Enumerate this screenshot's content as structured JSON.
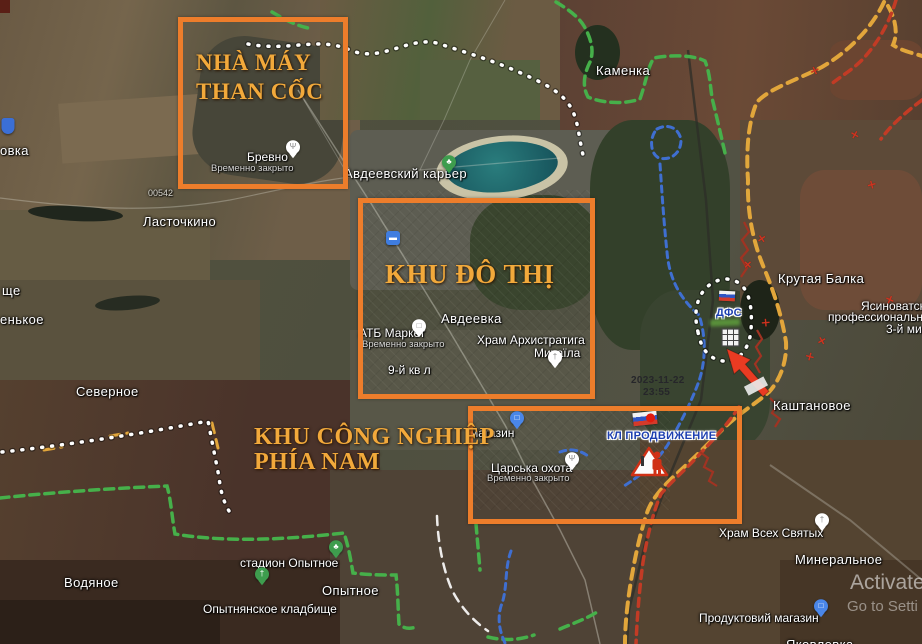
{
  "canvas": {
    "width": 922,
    "height": 644
  },
  "colors": {
    "annotation_orange": "#ed7d2b",
    "viet_yellow": "#f2a93b",
    "front_white": "#ffffff",
    "front_green": "#46b04a",
    "front_yellow": "#e2a63b",
    "front_red": "#c23b25",
    "front_blue": "#3f6fd1",
    "unit_blue": "#1d3fb0",
    "pin_white": "#ffffff",
    "pin_blue": "#4a86e8",
    "pin_green": "#3e9d4e"
  },
  "annotation_boxes": [
    {
      "name": "coke-plant-box",
      "x": 178,
      "y": 17,
      "w": 160,
      "h": 162
    },
    {
      "name": "urban-area-box",
      "x": 358,
      "y": 198,
      "w": 227,
      "h": 191
    },
    {
      "name": "south-industrial-box",
      "x": 468,
      "y": 406,
      "w": 264,
      "h": 108
    }
  ],
  "annotation_labels": [
    {
      "text": "NHÀ MÁY",
      "x": 196,
      "y": 50,
      "size": 23
    },
    {
      "text": "THAN CỐC",
      "x": 196,
      "y": 79,
      "size": 23
    },
    {
      "text": "KHU ĐÔ THỊ",
      "x": 385,
      "y": 259,
      "size": 27
    },
    {
      "text": "KHU CÔNG NGHIỆP",
      "x": 254,
      "y": 424,
      "size": 24
    },
    {
      "text": "PHÍA NAM",
      "x": 254,
      "y": 449,
      "size": 24
    }
  ],
  "map_labels": [
    {
      "text": "овка",
      "x": 0,
      "y": 143,
      "cls": "town"
    },
    {
      "text": "00542",
      "x": 148,
      "y": 188,
      "cls": "road"
    },
    {
      "text": "Ласточкино",
      "x": 143,
      "y": 214,
      "cls": "town"
    },
    {
      "text": "ще",
      "x": 2,
      "y": 283,
      "cls": "town"
    },
    {
      "text": "енькое",
      "x": 0,
      "y": 312,
      "cls": "town"
    },
    {
      "text": "Северное",
      "x": 76,
      "y": 384,
      "cls": "town"
    },
    {
      "text": "Водяное",
      "x": 64,
      "y": 575,
      "cls": "town"
    },
    {
      "text": "стадион Опытное",
      "x": 240,
      "y": 556,
      "cls": "poi"
    },
    {
      "text": "Опытное",
      "x": 322,
      "y": 583,
      "cls": "town"
    },
    {
      "text": "Опытнянское кладбище",
      "x": 203,
      "y": 602,
      "cls": "poi"
    },
    {
      "text": "Каменка",
      "x": 596,
      "y": 63,
      "cls": "town"
    },
    {
      "text": "Авдеевский карьер",
      "x": 344,
      "y": 166,
      "cls": "town"
    },
    {
      "text": "Бревно",
      "x": 247,
      "y": 150,
      "cls": "poi"
    },
    {
      "text": "Временно закрыто",
      "x": 211,
      "y": 163,
      "cls": "sub"
    },
    {
      "text": "Авдеевка",
      "x": 441,
      "y": 311,
      "cls": "town"
    },
    {
      "text": "АТБ Маркет",
      "x": 359,
      "y": 326,
      "cls": "poi"
    },
    {
      "text": "Временно закрыто",
      "x": 362,
      "y": 339,
      "cls": "sub"
    },
    {
      "text": "Храм Архистратига",
      "x": 477,
      "y": 333,
      "cls": "poi"
    },
    {
      "text": "Михаїла",
      "x": 534,
      "y": 346,
      "cls": "poi"
    },
    {
      "text": "9-й кв л",
      "x": 388,
      "y": 363,
      "cls": "poi"
    },
    {
      "text": "магазин",
      "x": 470,
      "y": 426,
      "cls": "poi"
    },
    {
      "text": "Царська охота",
      "x": 491,
      "y": 461,
      "cls": "poi"
    },
    {
      "text": "Временно закрыто",
      "x": 487,
      "y": 473,
      "cls": "sub"
    },
    {
      "text": "Крутая Балка",
      "x": 778,
      "y": 271,
      "cls": "town"
    },
    {
      "text": "Ясиноватск",
      "x": 861,
      "y": 299,
      "cls": "poi"
    },
    {
      "text": "профессиональны",
      "x": 828,
      "y": 310,
      "cls": "poi"
    },
    {
      "text": "3-й ми",
      "x": 886,
      "y": 322,
      "cls": "poi"
    },
    {
      "text": "Каштановое",
      "x": 773,
      "y": 398,
      "cls": "town"
    },
    {
      "text": "Храм Всех Святых",
      "x": 719,
      "y": 526,
      "cls": "poi"
    },
    {
      "text": "Минеральное",
      "x": 795,
      "y": 552,
      "cls": "town"
    },
    {
      "text": "Продуктовий магазин",
      "x": 699,
      "y": 611,
      "cls": "poi"
    },
    {
      "text": "Яковлевка",
      "x": 786,
      "y": 637,
      "cls": "town"
    }
  ],
  "pins": [
    {
      "type": "restaurant",
      "x": 293,
      "y": 157,
      "color": "#ffffff"
    },
    {
      "type": "park",
      "x": 449,
      "y": 172,
      "color": "#3e9d4e"
    },
    {
      "type": "transit",
      "x": 393,
      "y": 238,
      "color": "#3f7de0"
    },
    {
      "type": "shopping",
      "x": 419,
      "y": 336,
      "color": "#ffffff"
    },
    {
      "type": "church",
      "x": 555,
      "y": 367,
      "color": "#ffffff"
    },
    {
      "type": "shopping",
      "x": 517,
      "y": 428,
      "color": "#4a86e8"
    },
    {
      "type": "restaurant",
      "x": 572,
      "y": 469,
      "color": "#ffffff"
    },
    {
      "type": "church",
      "x": 822,
      "y": 530,
      "color": "#ffffff"
    },
    {
      "type": "park",
      "x": 336,
      "y": 557,
      "color": "#3e9d4e"
    },
    {
      "type": "cemetery",
      "x": 262,
      "y": 584,
      "color": "#3e9d4e"
    },
    {
      "type": "shopping",
      "x": 821,
      "y": 616,
      "color": "#4a86e8"
    },
    {
      "type": "shield",
      "x": 8,
      "y": 126,
      "color": "#3b6fd6"
    }
  ],
  "military": {
    "unit_label": {
      "text": "КЛ ПРОДВИЖЕНИЕ",
      "x": 607,
      "y": 430
    },
    "dfs_label": {
      "text": "ДФС",
      "x": 716,
      "y": 307
    },
    "date_stamp": {
      "line1": "2023-11-22",
      "line2": "23:55",
      "x": 631,
      "y": 375
    },
    "strike_markers": [
      {
        "x": 811,
        "y": 64,
        "r": 20
      },
      {
        "x": 851,
        "y": 128,
        "r": -15
      },
      {
        "x": 868,
        "y": 178,
        "r": 30
      },
      {
        "x": 758,
        "y": 232,
        "r": 10
      },
      {
        "x": 744,
        "y": 258,
        "r": 0
      },
      {
        "x": 886,
        "y": 293,
        "r": -20
      },
      {
        "x": 762,
        "y": 316,
        "r": 40
      },
      {
        "x": 818,
        "y": 334,
        "r": 15
      },
      {
        "x": 806,
        "y": 350,
        "r": -30
      }
    ]
  },
  "watermark": {
    "line1": "Activate",
    "line2": "Go to Setti"
  }
}
